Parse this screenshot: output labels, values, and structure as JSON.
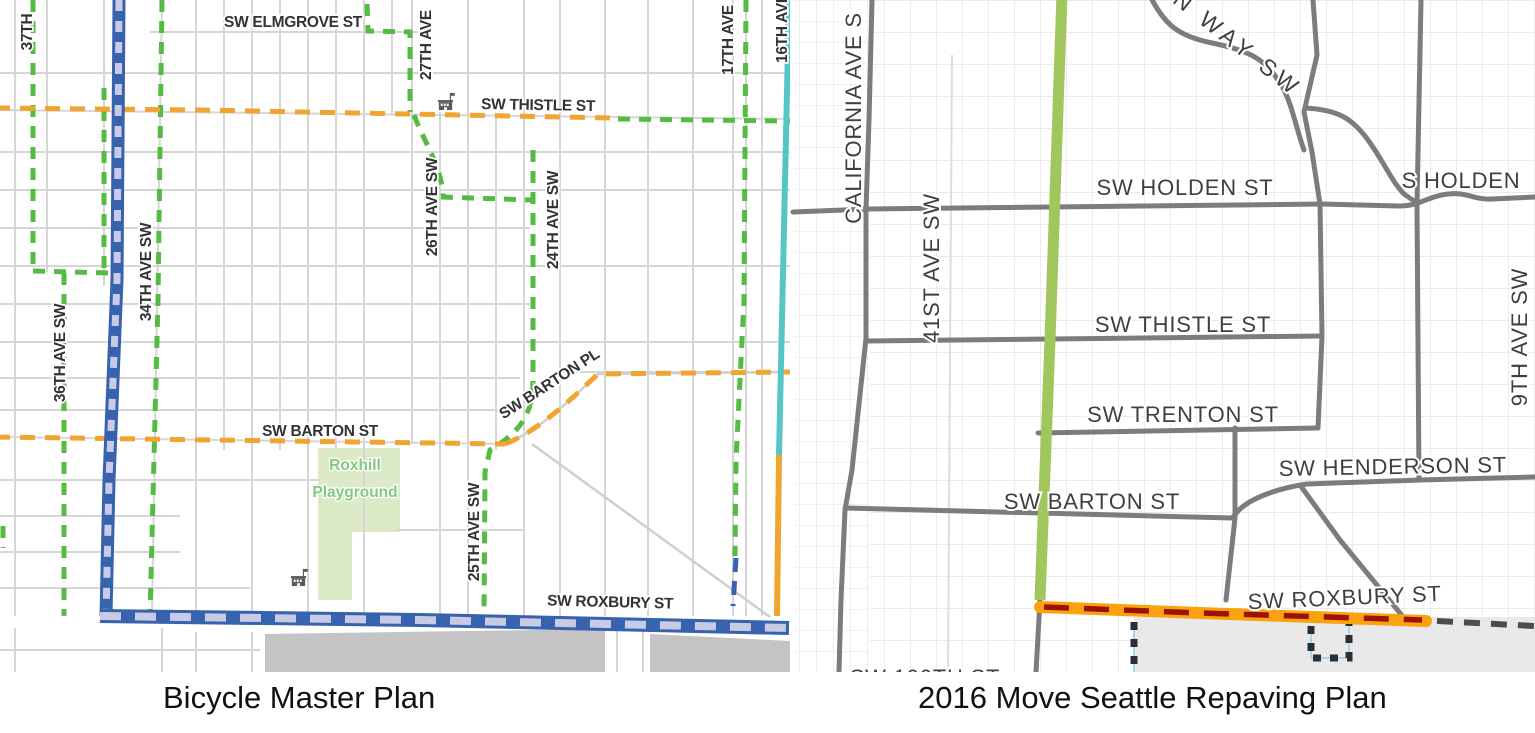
{
  "captions": {
    "left": "Bicycle Master Plan",
    "right": "2016 Move Seattle Repaving Plan"
  },
  "left_map": {
    "labels": {
      "st_37": "37TH",
      "elmgrove": "SW ELMGROVE ST",
      "ave_27": "27TH AVE",
      "thistle": "SW THISTLE ST",
      "ave_17": "17TH AVE",
      "ave_16": "16TH AVE",
      "ave_26": "26TH AVE SW",
      "ave_24": "24TH AVE SW",
      "ave_34": "34TH AVE SW",
      "ave_36": "36TH AVE SW",
      "ave_25": "25TH AVE SW",
      "barton_pl": "SW BARTON PL",
      "barton_st": "SW BARTON ST",
      "roxbury": "SW ROXBURY ST",
      "park_line1": "Roxhill",
      "park_line2": "Playground"
    }
  },
  "right_map": {
    "labels": {
      "california": "CALIFORNIA AVE S",
      "ave_41": "41ST AVE SW",
      "way_sw": "N WAY SW",
      "holden": "SW HOLDEN ST",
      "s_holden": "S HOLDEN",
      "thistle": "SW THISTLE ST",
      "trenton": "SW TRENTON ST",
      "henderson": "SW HENDERSON ST",
      "barton": "SW BARTON ST",
      "roxbury": "SW ROXBURY ST",
      "ave_9": "9TH AVE SW",
      "st_100": "SW 100TH ST"
    }
  },
  "colors": {
    "greenway_dashed": "#56BB44",
    "bike_lane_blue": "#3763AE",
    "bike_lane_blue_dash": "#C9CBE6",
    "in_street_orange": "#F0A432",
    "trail_teal": "#56C6C4",
    "repave_green": "#A2C65E",
    "repave_orange": "#FAA30F",
    "repave_red_dash": "#9C1206",
    "arterial_gray": "#7C7C7C",
    "boundary_dash": "#2E2E2E",
    "boundary_underlay": "#A8D4F0",
    "park_fill": "#DDEAC8",
    "park_label": "#83C97E",
    "city_gray_fill": "#C4C4C4",
    "suburb_gray_fill": "#E9E9E9",
    "school_icon": "#5A5A5A"
  }
}
